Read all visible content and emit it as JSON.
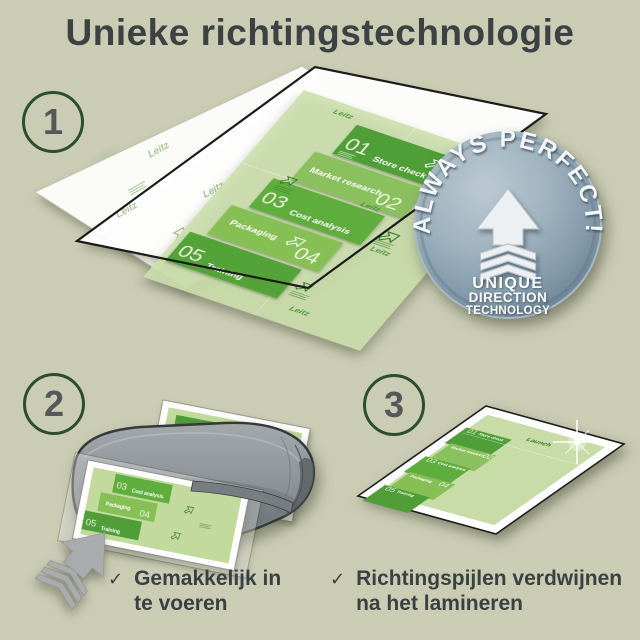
{
  "title": "Unieke richtingstechnologie",
  "steps": [
    {
      "number": "1"
    },
    {
      "number": "2"
    },
    {
      "number": "3"
    }
  ],
  "badge": {
    "arc_text": "ALWAYS PERFECT!",
    "lines": [
      "UNIQUE",
      "DIRECTION",
      "TECHNOLOGY"
    ]
  },
  "document": {
    "watermark": "Leitz",
    "launch_label": "Launch",
    "tiles": [
      {
        "number": "01",
        "label": "Store check"
      },
      {
        "number": "02",
        "label": "Market research"
      },
      {
        "number": "03",
        "label": "Cost analysis"
      },
      {
        "number": "04",
        "label": "Packaging"
      },
      {
        "number": "05",
        "label": "Training"
      }
    ]
  },
  "captions": [
    {
      "check": "✓",
      "line1": "Gemakkelijk in",
      "line2": "te voeren"
    },
    {
      "check": "✓",
      "line1": "Richtingspijlen verdwijnen",
      "line2": "na het lamineren"
    }
  ],
  "colors": {
    "background": "#cbccb4",
    "tile_dark_green": "#4f9e38",
    "tile_light_green": "#8ac05e",
    "badge_blue": "#7d93a4",
    "text": "#3c4243",
    "circle_ring": "#2b4e2b"
  }
}
